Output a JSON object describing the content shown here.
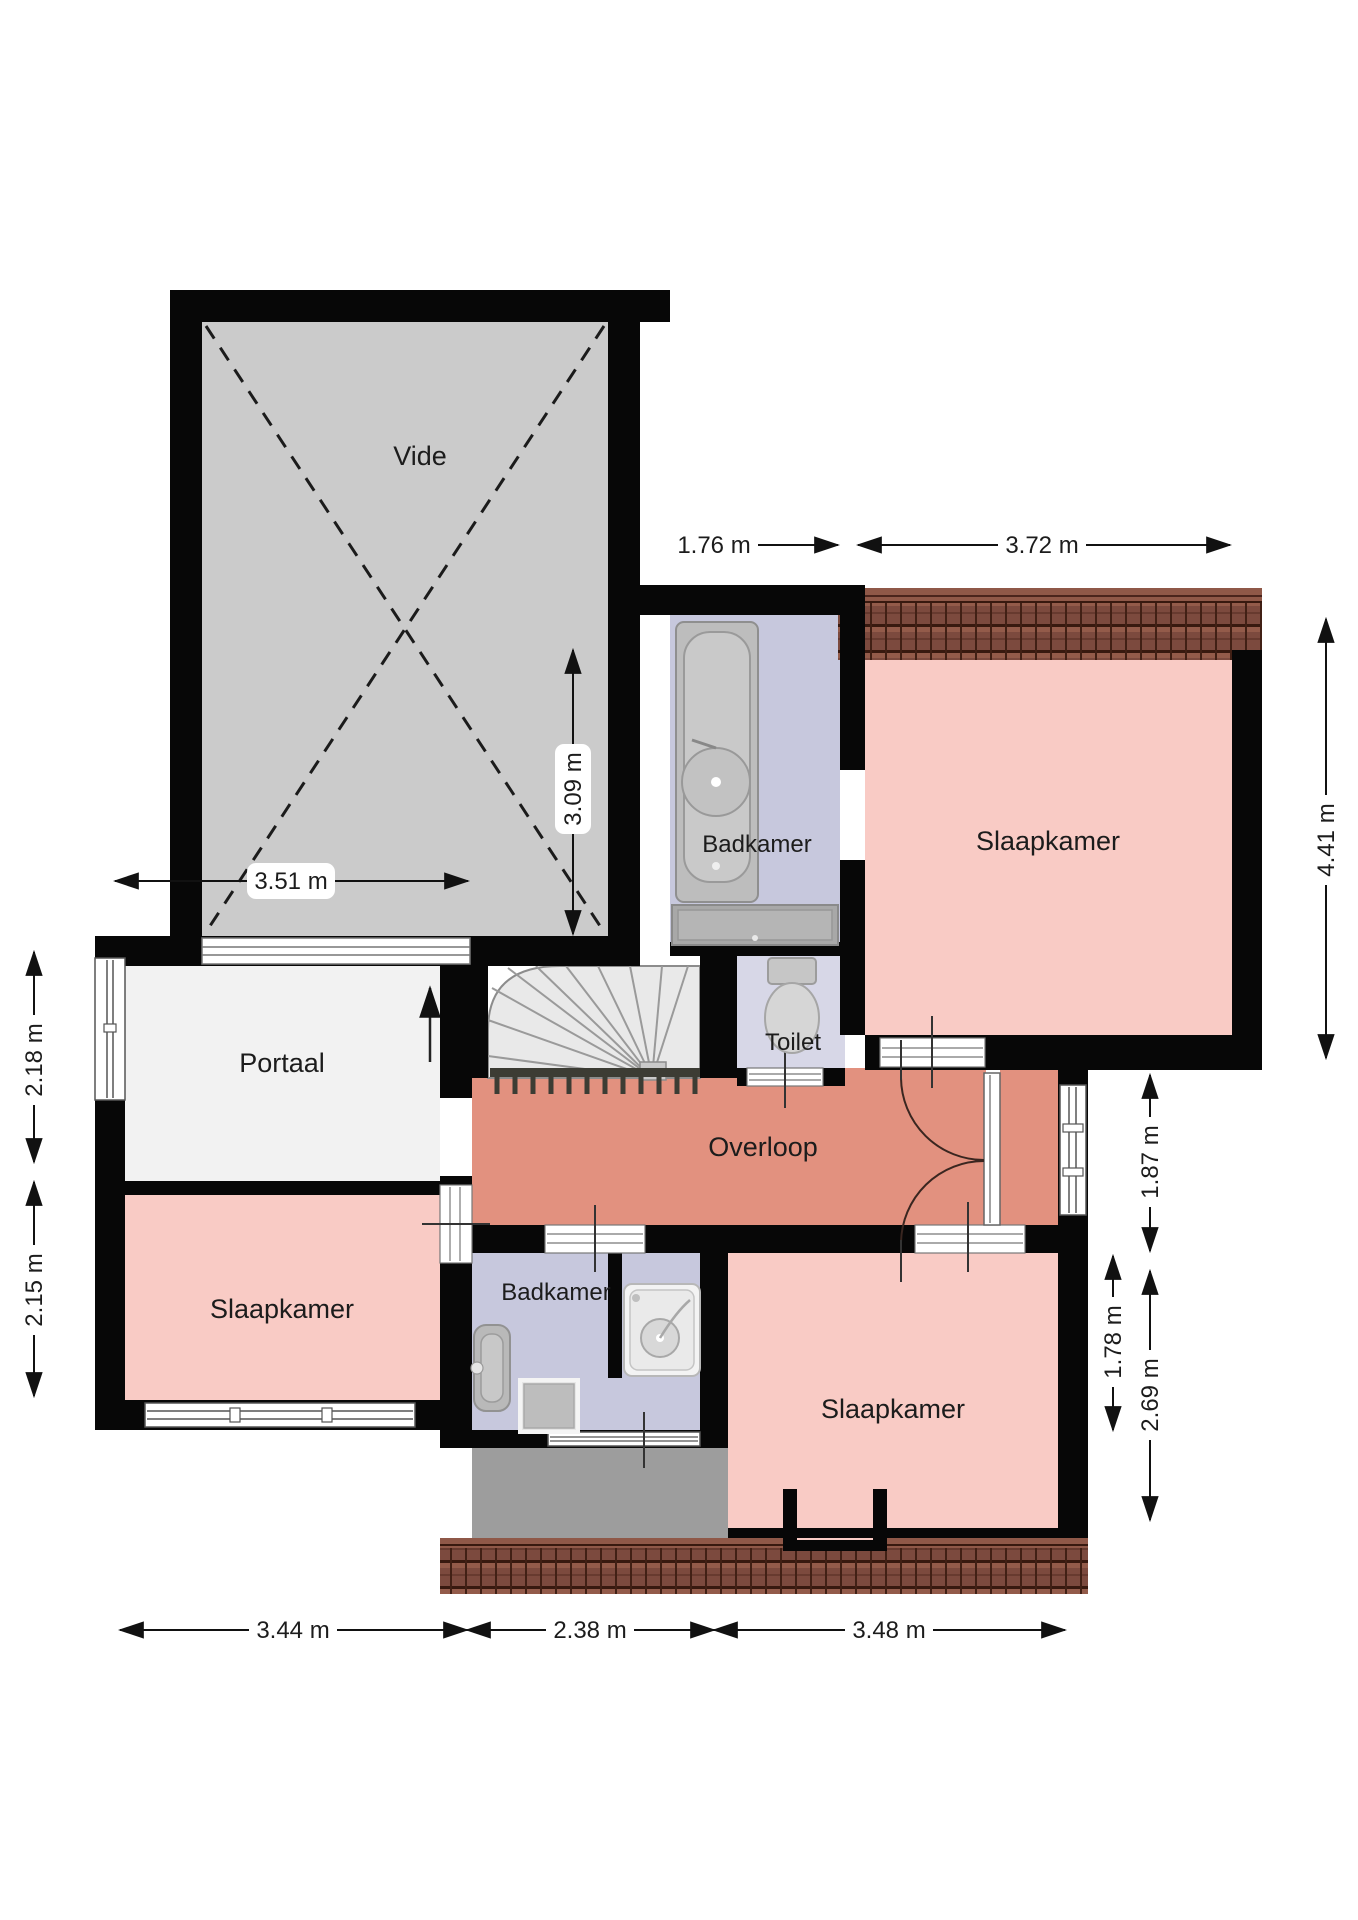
{
  "plan": {
    "type": "floor-plan",
    "language": "Dutch",
    "floor": "first floor (verdieping)"
  },
  "rooms": [
    {
      "id": "vide",
      "label": "Vide",
      "color": "#cbcbcb"
    },
    {
      "id": "badkamer-top",
      "label": "Badkamer",
      "color": "#c7c8dd"
    },
    {
      "id": "slaapkamer-topright",
      "label": "Slaapkamer",
      "color": "#f9cbc5"
    },
    {
      "id": "toilet",
      "label": "Toilet",
      "color": "#d7d7e7"
    },
    {
      "id": "portaal",
      "label": "Portaal",
      "color": "#f2f2f2"
    },
    {
      "id": "overloop",
      "label": "Overloop",
      "color": "#e2917f"
    },
    {
      "id": "slaapkamer-left",
      "label": "Slaapkamer",
      "color": "#f9cbc5"
    },
    {
      "id": "badkamer-bottom",
      "label": "Badkamer",
      "color": "#c7c8dd"
    },
    {
      "id": "slaapkamer-bottomright",
      "label": "Slaapkamer",
      "color": "#f9cbc5"
    }
  ],
  "dims": [
    {
      "id": "badkamer-top-width",
      "value": "1.76 m",
      "orientation": "horizontal"
    },
    {
      "id": "slaapkamer-topright-width",
      "value": "3.72 m",
      "orientation": "horizontal"
    },
    {
      "id": "vide-height",
      "value": "3.09 m",
      "orientation": "vertical"
    },
    {
      "id": "portaal-width",
      "value": "3.51 m",
      "orientation": "horizontal"
    },
    {
      "id": "slaapkamer-topright-height",
      "value": "4.41 m",
      "orientation": "vertical"
    },
    {
      "id": "portaal-height",
      "value": "2.18 m",
      "orientation": "vertical"
    },
    {
      "id": "slaapkamer-left-height",
      "value": "2.15 m",
      "orientation": "vertical"
    },
    {
      "id": "overloop-ext-height",
      "value": "1.87 m",
      "orientation": "vertical"
    },
    {
      "id": "slaapkamer-bottom-inner-height",
      "value": "1.78 m",
      "orientation": "vertical"
    },
    {
      "id": "slaapkamer-bottom-outer-height",
      "value": "2.69 m",
      "orientation": "vertical"
    },
    {
      "id": "bottom-left-width",
      "value": "3.44 m",
      "orientation": "horizontal"
    },
    {
      "id": "bottom-middle-width",
      "value": "2.38 m",
      "orientation": "horizontal"
    },
    {
      "id": "bottom-right-width",
      "value": "3.48 m",
      "orientation": "horizontal"
    }
  ],
  "fixtures": [
    "bathtub",
    "shower-head",
    "vanity-counter",
    "toilet-bowl",
    "staircase",
    "wall-sink",
    "shower-tray",
    "shower-cabin",
    "double-doors",
    "windows",
    "roof-tiles"
  ],
  "colors": {
    "wall": "#070707",
    "vide": "#cbcbcb",
    "pink_room": "#f9cbc5",
    "salmon_landing": "#e2917f",
    "lavender_bath": "#c7c8dd",
    "toilet_room": "#d7d7e7",
    "portal": "#f2f2f2",
    "roof_tile": "#7c4a3e",
    "slope_gray": "#9d9d9d"
  }
}
